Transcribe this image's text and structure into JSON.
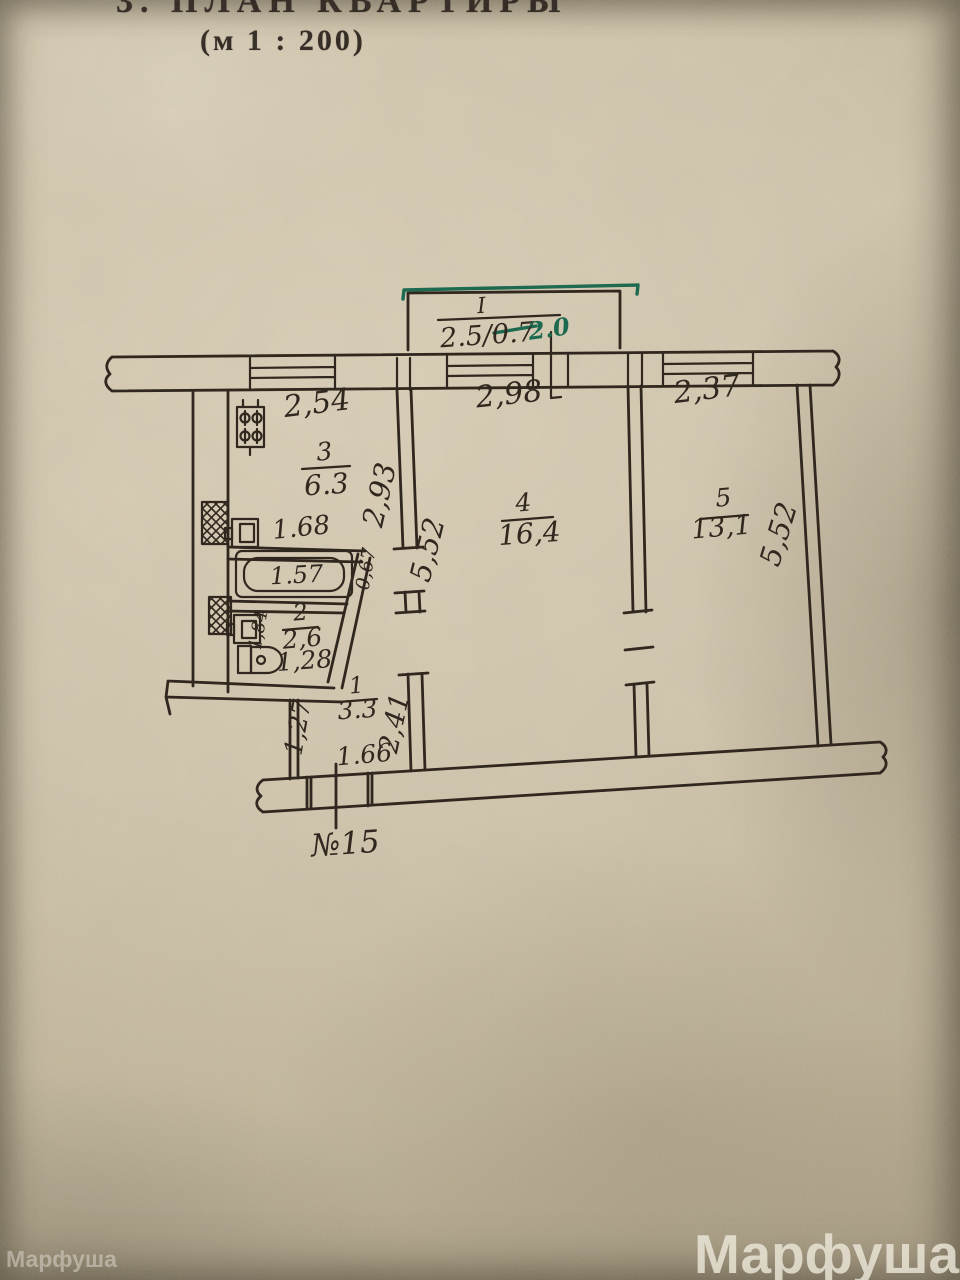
{
  "colors": {
    "paper": "#cdc1a9",
    "ink": "#30271e",
    "green": "#1e6a50",
    "title_ink": "#2b231c"
  },
  "header": {
    "title": "3. ПЛАН КВАРТИРЫ",
    "scale": "(м 1 : 200)"
  },
  "plan": {
    "apartment_number": "№15",
    "balcony": {
      "label": "I",
      "dimension": "2.5/0.7",
      "green_note": "2.0"
    },
    "rooms": {
      "kitchen": {
        "number": "3",
        "area": "6.3",
        "width": "2,54",
        "depth": "2,93"
      },
      "room4": {
        "number": "4",
        "area": "16,4",
        "width": "2,98",
        "depth": "5,52"
      },
      "room5": {
        "number": "5",
        "area": "13,1",
        "width": "2,37",
        "depth": "5,52"
      },
      "bath": {
        "width": "1.68",
        "tub": "1.57"
      },
      "toilet": {
        "number": "2",
        "area": "2,6",
        "depth": "1,84",
        "pan": "1,28"
      },
      "hall": {
        "number": "1",
        "area": "3.3",
        "door_width": "0,67",
        "passage": "2,41",
        "entry_depth": "1,27",
        "entry_width": "1.66"
      }
    }
  },
  "watermarks": {
    "small": "Марфуша",
    "large": "Марфуша"
  }
}
